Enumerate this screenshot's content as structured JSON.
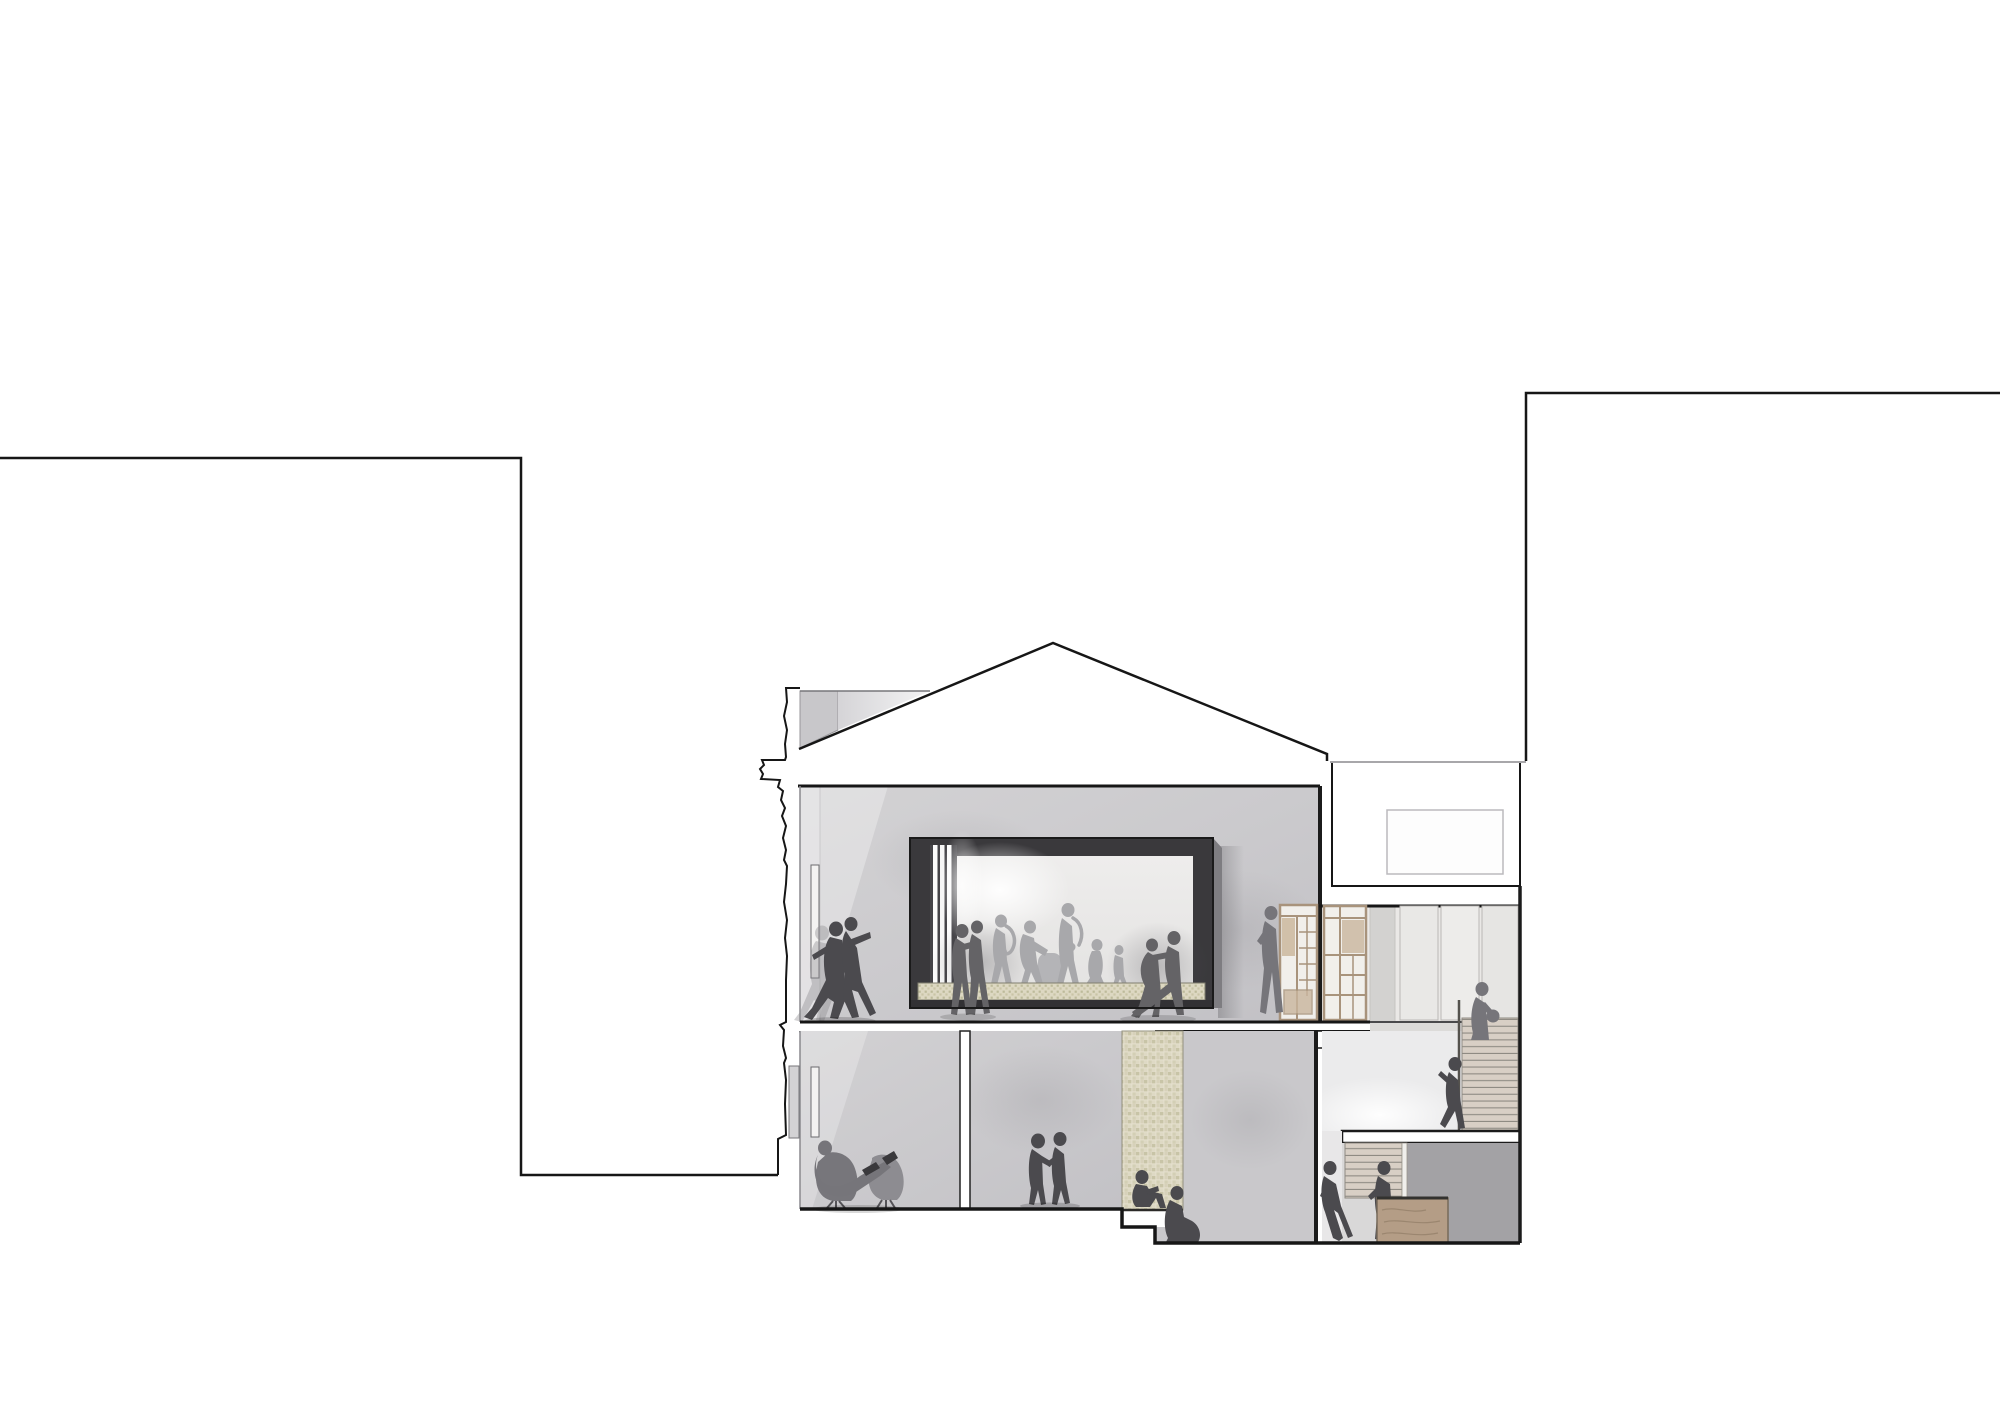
{
  "document": {
    "title": "Architectural cross-section drawing of a two-storey hall between neighbouring buildings",
    "drawing_type": "building section / elevation, presentation style",
    "visible_text": ""
  },
  "colors": {
    "background": "#ffffff",
    "line": "#161616",
    "wall": "#cbcacd",
    "wall_deep": "#c0bfc3",
    "wall_light": "#eae8e6",
    "wall_lighter": "#ebebec",
    "wall_dark": "#a3a2a5",
    "roof_block_dark": "#c8c7ca",
    "roof_block_light": "#dcdbde",
    "window_frame": "#3a393c",
    "window_frame_side": "#7e7d81",
    "bay_light": "#ecebeb",
    "slat_white": "#fcfcfc",
    "tile_bg": "#e5e0ce",
    "tile_olive": "#b0ad86",
    "tile_sand": "#cdc7ad",
    "figure_dark": "#4b4a4e",
    "figure_mid": "#646366",
    "figure_soft": "#76757a",
    "figure_light": "#a8a8ab",
    "chair_gray": "#7d7c81",
    "wood_frame": "#a8937c",
    "wood_panel": "#f1efeb",
    "wood_tan": "#c9b59d",
    "plank": "#d8cfc5",
    "plank_line": "#8e8a82",
    "box_wood": "#b49d86",
    "slab_white": "#ffffff"
  },
  "scene": {
    "context": {
      "left_neighbor": "blank party-wall outline of adjacent building, left side",
      "right_neighbor": "blank party-wall outline of adjacent building, right side",
      "roof": "pitched gable roof over main hall",
      "roof_volume": "flat white roof volume with skylight between gable and right neighbor"
    },
    "rooms": [
      {
        "id": "upper-hall",
        "label": "upper dance hall with large inset window bay"
      },
      {
        "id": "window-bay",
        "label": "deep window bay with band and dancers behind, tiled sill"
      },
      {
        "id": "upper-corridor",
        "label": "upper corridor with timber screen partitions"
      },
      {
        "id": "stair-hall",
        "label": "stair hall with straight timber stair"
      },
      {
        "id": "lower-lounge",
        "label": "ground floor lounge with two swivel chairs"
      },
      {
        "id": "lower-room",
        "label": "ground floor room with standing couple"
      },
      {
        "id": "tiled-pier",
        "label": "cement-tile clad pier between ground floor rooms"
      },
      {
        "id": "sunken-room",
        "label": "sunken seating room right of tiled pier"
      },
      {
        "id": "basement-stair-room",
        "label": "lower stair room with plywood box and dark wall"
      }
    ],
    "figures": [
      {
        "id": "tango-couple-left",
        "tone": "dark",
        "where": "upper-hall"
      },
      {
        "id": "embracing-couple",
        "tone": "mid",
        "where": "window-bay front"
      },
      {
        "id": "sax-player-1",
        "tone": "light",
        "where": "window-bay"
      },
      {
        "id": "conga-player",
        "tone": "light",
        "where": "window-bay"
      },
      {
        "id": "sax-player-2",
        "tone": "light",
        "where": "window-bay"
      },
      {
        "id": "walking-woman",
        "tone": "light",
        "where": "window-bay"
      },
      {
        "id": "child",
        "tone": "light",
        "where": "window-bay"
      },
      {
        "id": "tango-couple-right",
        "tone": "mid",
        "where": "window-bay front"
      },
      {
        "id": "person-at-screen",
        "tone": "soft",
        "where": "upper-corridor"
      },
      {
        "id": "woman-with-bag",
        "tone": "soft",
        "where": "top of stair"
      },
      {
        "id": "person-descending-stair",
        "tone": "dark",
        "where": "stair-hall"
      },
      {
        "id": "reclining-man-on-chairs",
        "tone": "mid",
        "where": "lower-lounge"
      },
      {
        "id": "standing-couple",
        "tone": "dark",
        "where": "lower-room"
      },
      {
        "id": "person-sitting-on-step",
        "tone": "dark",
        "where": "tiled pier base"
      },
      {
        "id": "woman-sitting-on-floor",
        "tone": "dark",
        "where": "sunken-room"
      },
      {
        "id": "person-leaning-on-wall",
        "tone": "dark",
        "where": "basement-stair-room"
      },
      {
        "id": "person-at-plywood-box",
        "tone": "dark",
        "where": "basement-stair-room"
      }
    ]
  }
}
